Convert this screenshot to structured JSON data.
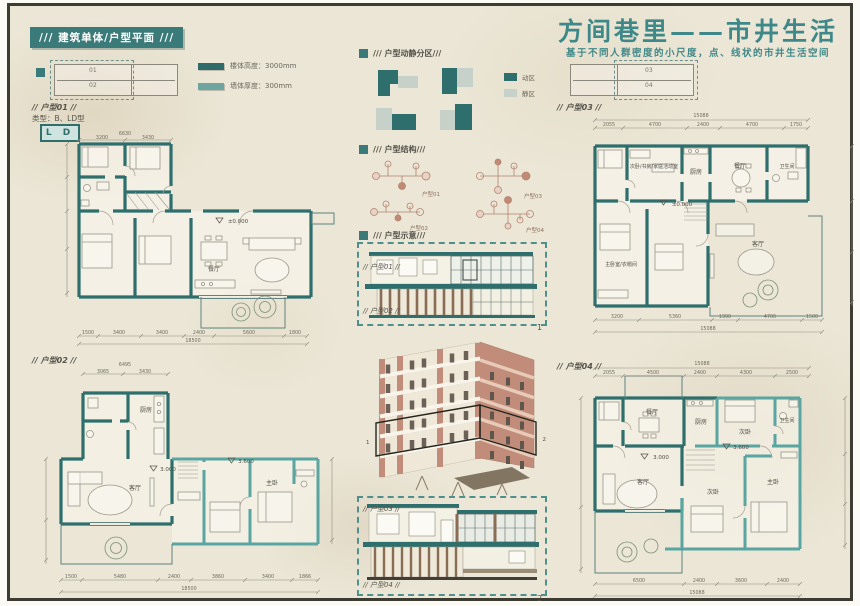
{
  "board": {
    "badge": "/// 建筑单体/户型平面 ///",
    "title": "方间巷里——市井生活",
    "subtitle": "基于不同人群密度的小尺度，点、线状的市井生活空间"
  },
  "legend": {
    "wall_height": "楼体高度：3000mm",
    "wall_thickness": "墙体厚度：300mm"
  },
  "keyplan_left": {
    "unit_top": "01",
    "unit_bottom": "02"
  },
  "keyplan_right": {
    "unit_top": "03",
    "unit_bottom": "04"
  },
  "zoning": {
    "title": "/// 户型动静分区///",
    "active": "动区",
    "quiet": "静区"
  },
  "structure": {
    "title": "/// 户型结构///",
    "d1": "户型01",
    "d2": "户型02",
    "d3": "户型03",
    "d4": "户型04"
  },
  "schematic": {
    "title": "/// 户型示意///",
    "sec1_top": "// 户型01 //",
    "sec1_bottom": "// 户型02 //",
    "sec1_index": "1",
    "sec2_top": "// 户型03 //",
    "sec2_bottom": "// 户型04 //",
    "sec2_index": "2",
    "axon_marker_left": "1",
    "axon_marker_right": "2"
  },
  "plans": {
    "p1": {
      "header": "// 户型01 //",
      "type_note": "类型：B、LD型",
      "badge": "L D",
      "level": "±0.000",
      "room_dining": "餐厅",
      "dim_top_total": "6630",
      "dim_top": [
        "3200",
        "3430"
      ],
      "dim_bottom": [
        "1500",
        "3400",
        "3400",
        "2400",
        "5600",
        "1800"
      ],
      "dim_bottom_total": "18500"
    },
    "p2": {
      "header": "// 户型02 //",
      "level_a": "3.000",
      "level_b": "3.600",
      "room_living": "客厅",
      "room_kitchen": "厨房",
      "room_master": "主卧",
      "dim_top_total": "6495",
      "dim_top": [
        "3065",
        "3430"
      ],
      "dim_bottom": [
        "1500",
        "5480",
        "2400",
        "3860",
        "3400",
        "1866"
      ],
      "dim_bottom_total": "18500"
    },
    "p3": {
      "header": "// 户型03 //",
      "level": "±0.000",
      "room_multi": "次卧/书房/家庭活动室",
      "room_kitchen": "厨房",
      "room_dining": "餐厅",
      "room_bath": "卫生间",
      "room_master": "主卧室/衣帽间",
      "room_living": "客厅",
      "dim_top_total": "15088",
      "dim_top": [
        "2055",
        "4700",
        "2400",
        "4700",
        "1750"
      ],
      "dim_bottom": [
        "3200",
        "5360",
        "1900",
        "4700",
        "1500"
      ],
      "dim_bottom_total": "15088"
    },
    "p4": {
      "header": "// 户型04 //",
      "level_a": "3.000",
      "level_b": "3.600",
      "room_dining": "餐厅",
      "room_kitchen": "厨房",
      "room_bed2": "次卧",
      "room_bath": "卫生间",
      "room_living": "客厅",
      "room_bed3": "次卧",
      "room_master": "主卧",
      "dim_top_total": "15088",
      "dim_top": [
        "2055",
        "4500",
        "2400",
        "4300",
        "2500"
      ],
      "dim_bottom": [
        "6500",
        "2400",
        "3600",
        "2400"
      ],
      "dim_bottom_total": "15088"
    }
  },
  "colors": {
    "wall_teal": "#2e6f6d",
    "wall_teal_light": "#58a5a2",
    "badge_teal": "#3a7a78",
    "title_teal": "#3f8889",
    "brick": "#c18d7a",
    "paper": "#ebe6d6",
    "quiet_zone_fill": "#c6d2c9"
  }
}
